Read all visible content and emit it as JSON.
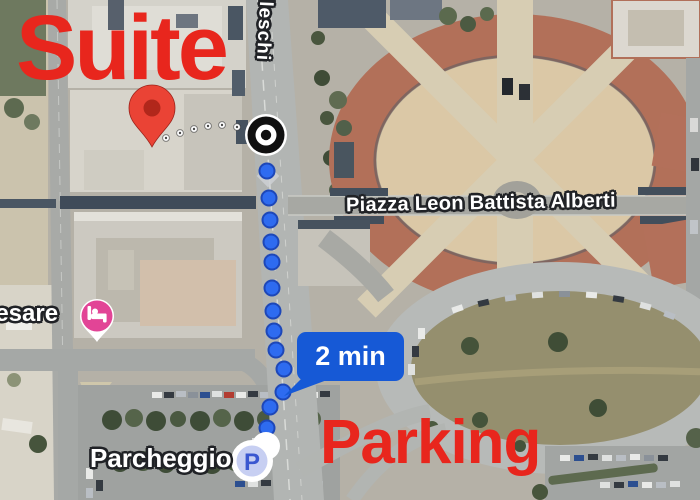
{
  "annotations": {
    "suite_label": "Suite",
    "parking_label": "Parking"
  },
  "map_labels": {
    "piazza": "Piazza Leon Battista Alberti",
    "street": "elleschi",
    "hotel": "Cesare",
    "parking_lot": "Parcheggio"
  },
  "route": {
    "duration": "2 min",
    "dots": [
      [
        267,
        171
      ],
      [
        269,
        198
      ],
      [
        270,
        220
      ],
      [
        271,
        242
      ],
      [
        272,
        262
      ],
      [
        272,
        288
      ],
      [
        273,
        311
      ],
      [
        274,
        331
      ],
      [
        276,
        350
      ],
      [
        284,
        369
      ],
      [
        283,
        392
      ],
      [
        270,
        407
      ],
      [
        267,
        428
      ]
    ],
    "connector_dots": [
      [
        166,
        138
      ],
      [
        180,
        133
      ],
      [
        194,
        129
      ],
      [
        208,
        126
      ],
      [
        222,
        125
      ],
      [
        237,
        127
      ]
    ]
  },
  "markers": {
    "parking_letter": "P"
  },
  "colors": {
    "annotation_red": "#e8261d",
    "route_blue": "#2e6bf0",
    "route_blue_border": "#1d47b8",
    "badge_blue": "#1659d6",
    "pin_red": "#EA4335",
    "pin_red_dark": "#b1271b",
    "lodging_pink": "#e24496",
    "parking_letter_blue": "#3a57d0",
    "parking_icon_inner": "#c7cff2"
  }
}
